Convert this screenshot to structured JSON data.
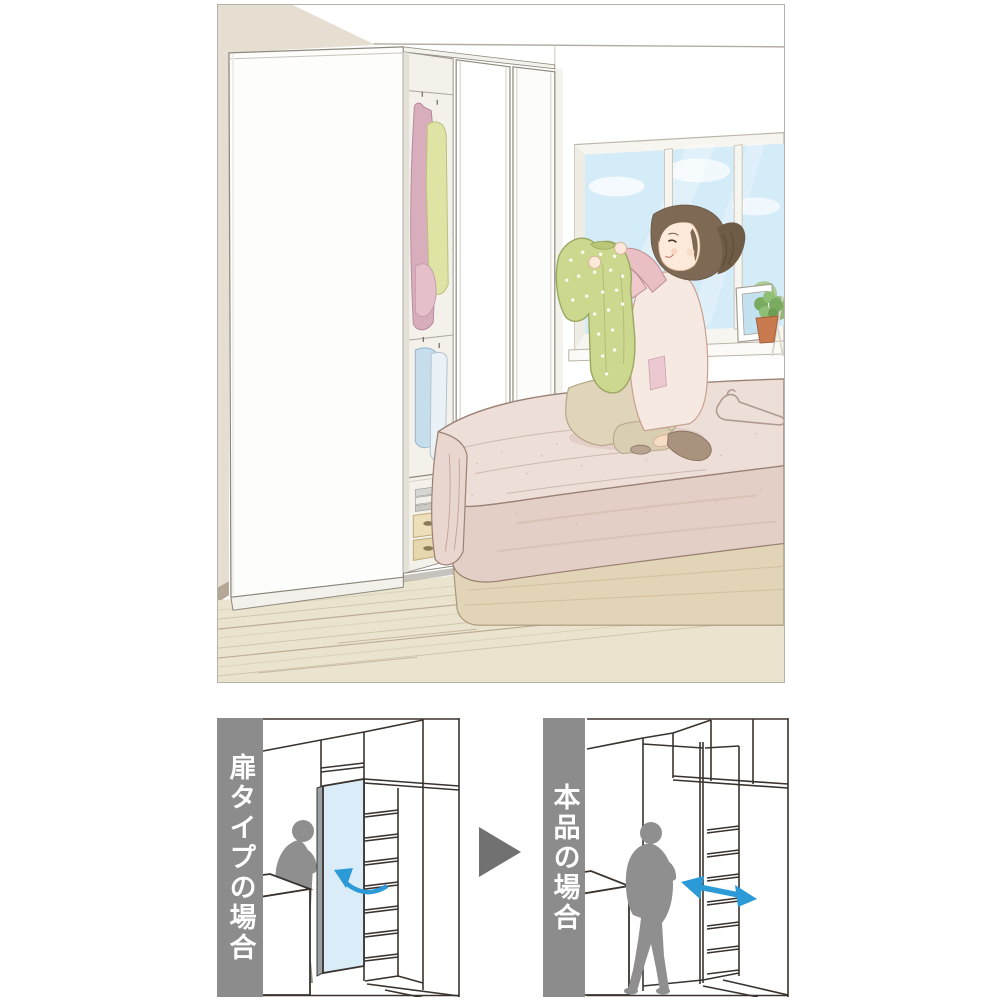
{
  "comparison": {
    "before": {
      "label": "扉タイプの場合",
      "arrow_icon": "door-swing-arc-arrow",
      "door_fill": "#d9ecf8"
    },
    "after": {
      "label": "本品の場合",
      "arrow_icon": "slide-double-headed-arrow"
    },
    "transition_icon": "triangle-right-arrow"
  },
  "scene": {
    "description": "Illustrated bedroom: a woman kneels on a bed holding up a green polka-dot shirt beside a tall white wardrobe whose sliding door is open, revealing hanging clothes, folded towels and storage boxes; a bright window with a plant and picture frame is behind her."
  },
  "colors": {
    "banner_gray": "#8c8c8c",
    "label_text": "#ffffff",
    "diagram_line": "#3a332d",
    "blue_arrow": "#2b9ad6",
    "door_blue": "#d9ecf8",
    "transition_gray": "#717171",
    "silhouette_gray": "#8f8f8f",
    "illus_border": "#b5b2ac"
  }
}
